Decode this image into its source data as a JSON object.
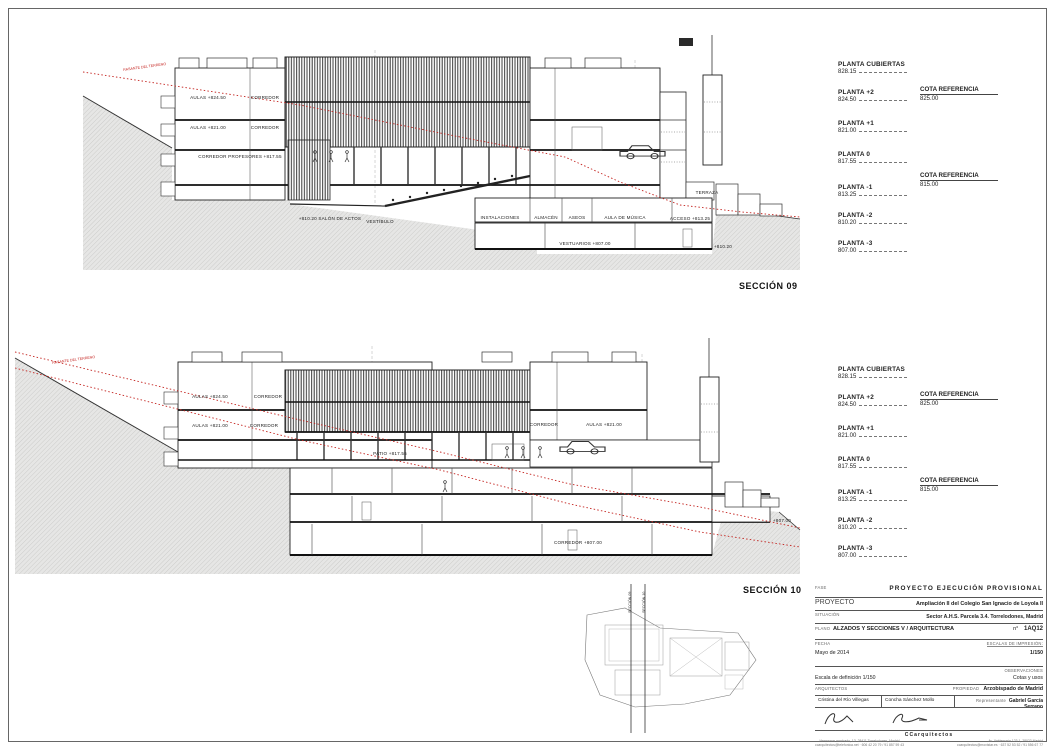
{
  "sections": {
    "s09": {
      "title": "SECCIÓN 09",
      "terrain_label": "RASANTE DEL TERRENO",
      "rooms": {
        "aulas_top": "AULAS +824.50",
        "corredor_top": "CORREDOR",
        "aulas_mid": "AULAS +821.00",
        "corredor_mid": "CORREDOR",
        "corredor_prof": "CORREDOR PROFESORES +817.55",
        "salon": "+810.20 SALÓN DE ACTOS",
        "vestibulo": "VESTÍBULO",
        "instalaciones": "INSTALACIONES",
        "almacen": "ALMACÉN",
        "aseos": "ASEOS",
        "aula_musica": "AULA DE MÚSICA",
        "acceso": "ACCESO +813.25",
        "vestuarios": "VESTUARIOS +807.00",
        "cota_810": "+810.20",
        "terraza": "TERRAZA"
      }
    },
    "s10": {
      "title": "SECCIÓN 10",
      "terrain_label": "RASANTE DEL TERRENO",
      "rooms": {
        "aulas_top": "AULAS +824.50",
        "corredor_top": "CORREDOR",
        "aulas_mid": "AULAS +821.00",
        "corredor_mid": "CORREDOR",
        "patio": "PATIO +817.55",
        "corredor_right": "CORREDOR",
        "aulas_right": "AULAS +821.00",
        "corredor_bajo": "CORREDOR +807.00",
        "cota_807": "+807.00"
      }
    }
  },
  "levels": [
    {
      "name": "PLANTA CUBIERTAS",
      "value": "828.15"
    },
    {
      "name": "PLANTA +2",
      "value": "824.50"
    },
    {
      "name": "PLANTA +1",
      "value": "821.00"
    },
    {
      "name": "PLANTA 0",
      "value": "817.55"
    },
    {
      "name": "PLANTA -1",
      "value": "813.25"
    },
    {
      "name": "PLANTA -2",
      "value": "810.20"
    },
    {
      "name": "PLANTA -3",
      "value": "807.00"
    }
  ],
  "cotas": [
    {
      "label": "COTA REFERENCIA",
      "value": "825.00"
    },
    {
      "label": "COTA REFERENCIA",
      "value": "815.00"
    }
  ],
  "keyplan": {
    "line09": "SECCIÓN 09",
    "line10": "SECCIÓN 10"
  },
  "titleblock": {
    "fase_label": "FASE",
    "fase_value": "PROYECTO EJECUCIÓN PROVISIONAL",
    "proyecto_label": "PROYECTO",
    "proyecto_value": "Ampliación II del Colegio San Ignacio de Loyola II",
    "situacion_label": "SITUACIÓN",
    "situacion_value": "Sector A.H.S.   Parcela 3.4.  Torrelodones, Madrid",
    "plano_label": "PLANO",
    "plano_value": "ALZADOS Y SECCIONES V / ARQUITECTURA",
    "num_label": "n°",
    "num_value": "1AQ12",
    "fecha_label": "FECHA",
    "fecha_value": "Mayo de 2014",
    "escalas_label": "ESCALAS DE IMPRESIÓN:",
    "escalas_value": "1/150",
    "observaciones_label": "OBSERVACIONES",
    "escala_def": "Escala de definición 1/150",
    "observaciones_value": "Cotas y usos",
    "arquitectos_label": "ARQUITECTOS",
    "arquitecto_1": "Cristina del Río Villegas",
    "arquitecto_2": "Concha Sánchez Mollo",
    "propiedad_label": "PROPIEDAD",
    "propiedad_value": "Arzobispado de Madrid",
    "representante_label": "Representante",
    "representante_value": "Gabriel García Serrano",
    "firm": "CCarquitectos",
    "addr1a": "Hermanos machado, 13. 28411 Torrelodones, Madrid",
    "addr1b": "ccarquitectos@telefonica.net · 606 42 20 79 / 91 857 59 43",
    "addr2a": "Av. Valdemarín 123 1, 28023 Madrid",
    "addr2b": "ccarquitectos@movistar.es · 637 52 53 52 / 91 556 67 77"
  }
}
